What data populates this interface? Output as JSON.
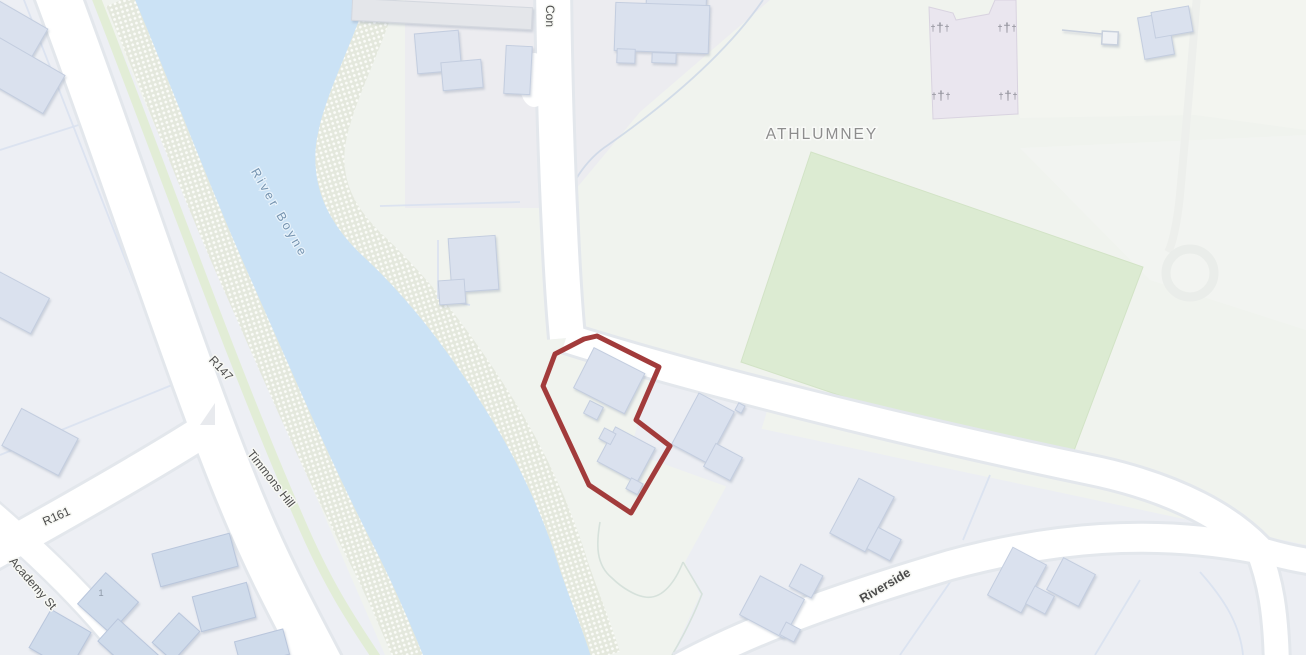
{
  "map": {
    "type": "street-map",
    "labels": {
      "place": "ATHLUMNEY",
      "river": "River Boyne",
      "road_truncated_top": "Con",
      "r147": "R147",
      "r161": "R161",
      "timmons_hill": "Timmons Hill",
      "academy_st": "Academy St",
      "riverside": "Riverside",
      "house_number": "1"
    },
    "cemetery": {
      "cross_glyph": "†",
      "marker_count": 4
    },
    "selected_parcel": {
      "outlined": true
    },
    "colors": {
      "background": "#f0f3ee",
      "urban_area": "#edeff4",
      "river": "#cbe2f5",
      "riverbank_base": "#e4e8dd",
      "field_green": "#dcebd2",
      "cemetery_pink": "#eae6ef",
      "building_fill": "#dae1ee",
      "road_fill": "#ffffff",
      "parcel_outline": "#a23b3b",
      "road_label": "#4b4b4b",
      "river_label": "#7694b0",
      "place_label": "#8d8d8d"
    }
  }
}
